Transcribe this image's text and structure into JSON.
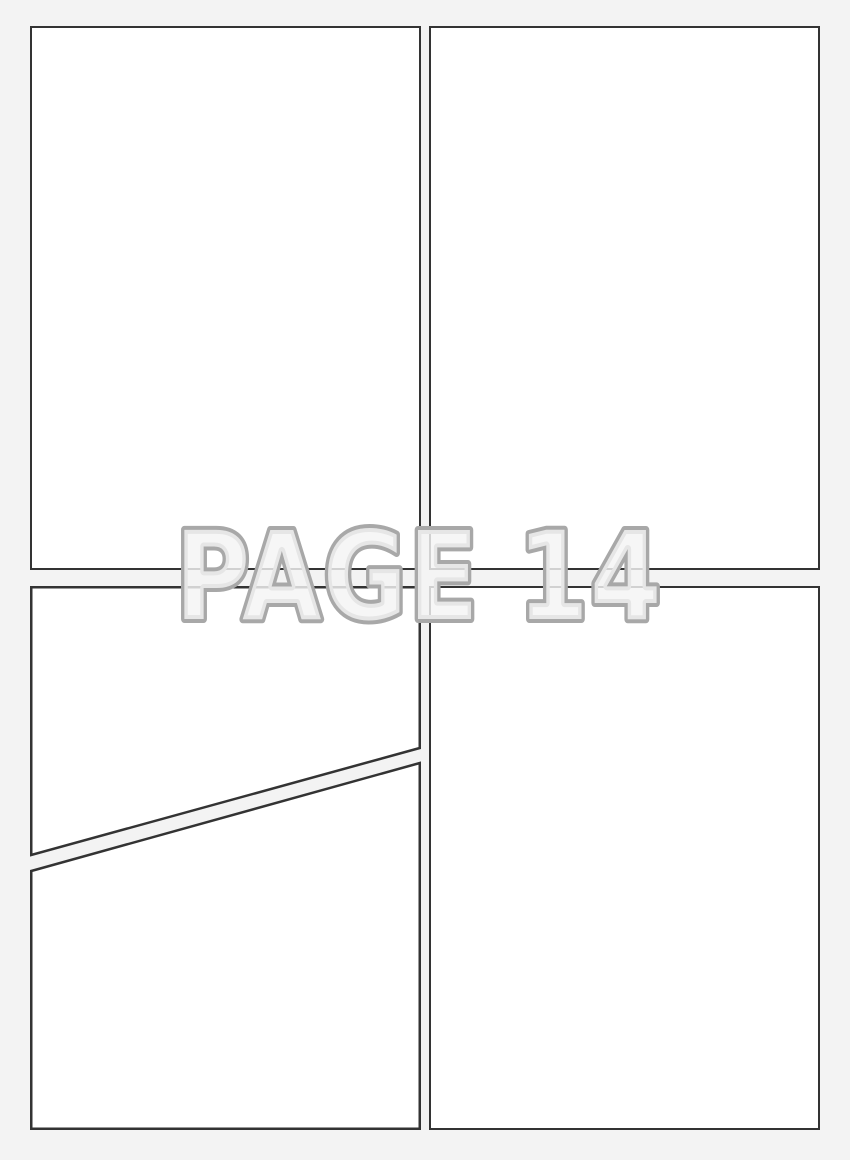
{
  "watermark": {
    "label": "PAGE 14"
  },
  "theme": {
    "bg": "#f3f3f3",
    "panel-fill": "#ffffff",
    "panel-line": "#333333",
    "wm-stroke": "#a8a8a8",
    "wm-fill": "rgba(244,244,244,0.82)"
  }
}
